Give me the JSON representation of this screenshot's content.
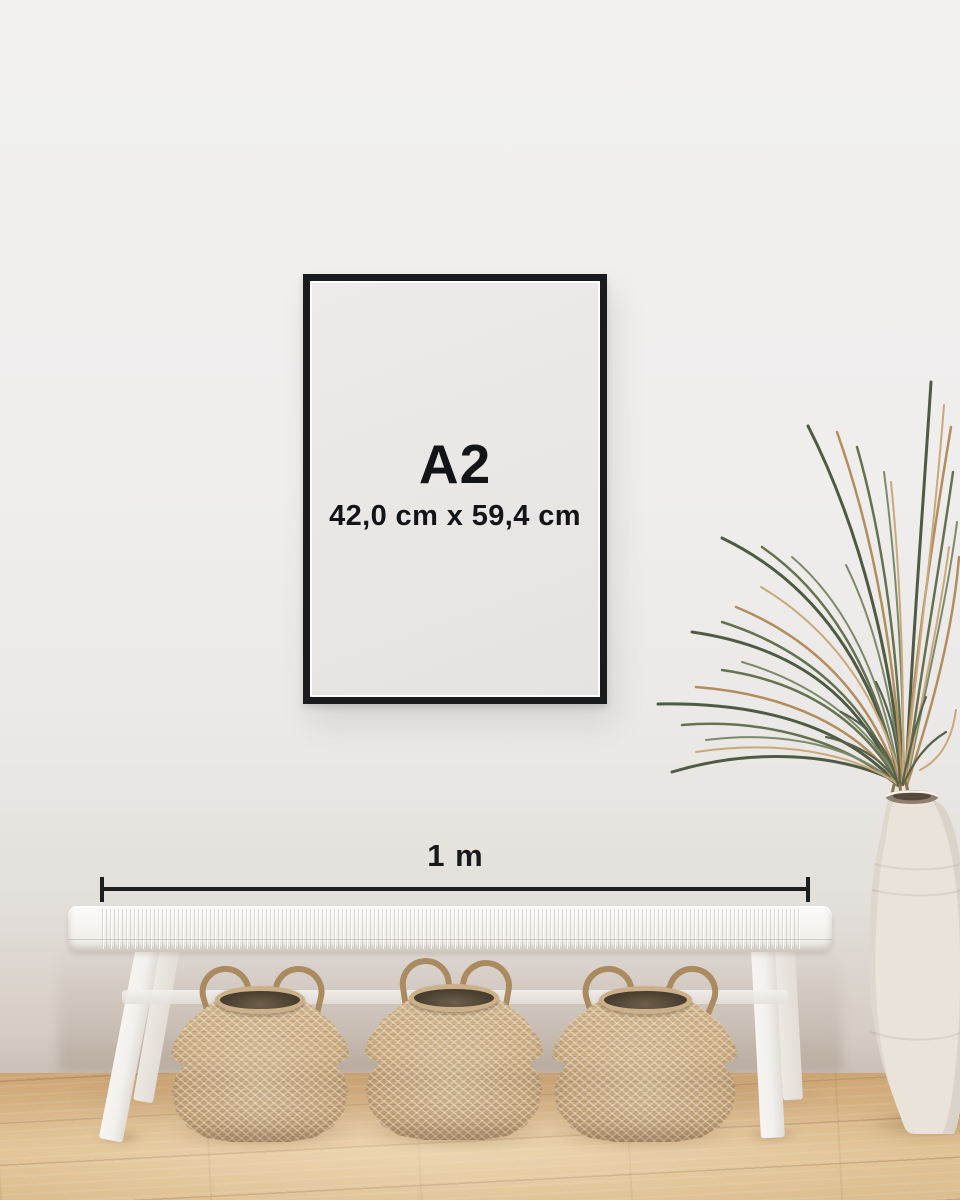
{
  "frame": {
    "size_label": "A2",
    "dimensions_label": "42,0 cm x 59,4 cm"
  },
  "scale_bar": {
    "label": "1 m"
  },
  "scene_objects": {
    "wall": "white wall",
    "floor": "light oak wood floor",
    "frame": "black picture frame",
    "bench": "white woven bench",
    "basket_left": "seagrass belly basket",
    "basket_middle": "seagrass belly basket",
    "basket_right": "seagrass belly basket",
    "plant": "dried palm plant",
    "vase": "white ceramic floor vase"
  },
  "colors": {
    "wall": "#efeeed",
    "frame_border": "#191b1e",
    "frame_matte": "#e9e7e5",
    "text": "#131417",
    "scale_line": "#1d1e1f",
    "floor": "#dab88a",
    "bench": "#f4f2ef",
    "basket": "#c2a47d",
    "plant_green": "#5d6950",
    "plant_tan": "#b28d5e",
    "vase": "#e9e3da"
  }
}
